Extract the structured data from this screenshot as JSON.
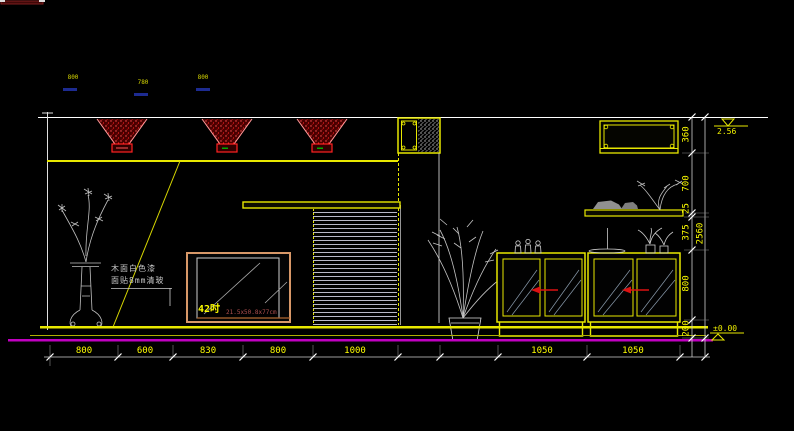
{
  "canvas": {
    "width": 794,
    "height": 431,
    "background": "#000000"
  },
  "colors": {
    "wall_lines": "#e8e800",
    "construction_lines": "#d0d0d0",
    "floor_datum": "#c000c0",
    "light_red": "#dd1111",
    "tv_frame": "#d89868",
    "dimension_text": "#ffff00"
  },
  "tv": {
    "label": "42吋",
    "spec": "21.5x50.8x77cm"
  },
  "note": {
    "line1": "木面白色漆",
    "line2": "面贴8mm清玻"
  },
  "top_labels": [
    "800",
    "780",
    "800"
  ],
  "dims": {
    "bottom": [
      "800",
      "600",
      "830",
      "800",
      "1000",
      "1050",
      "1050"
    ],
    "right": [
      "360",
      "700",
      "25",
      "375",
      "800",
      "200"
    ],
    "overall": "2560"
  },
  "levels": {
    "top": "2.56",
    "bottom": "±0.00"
  }
}
